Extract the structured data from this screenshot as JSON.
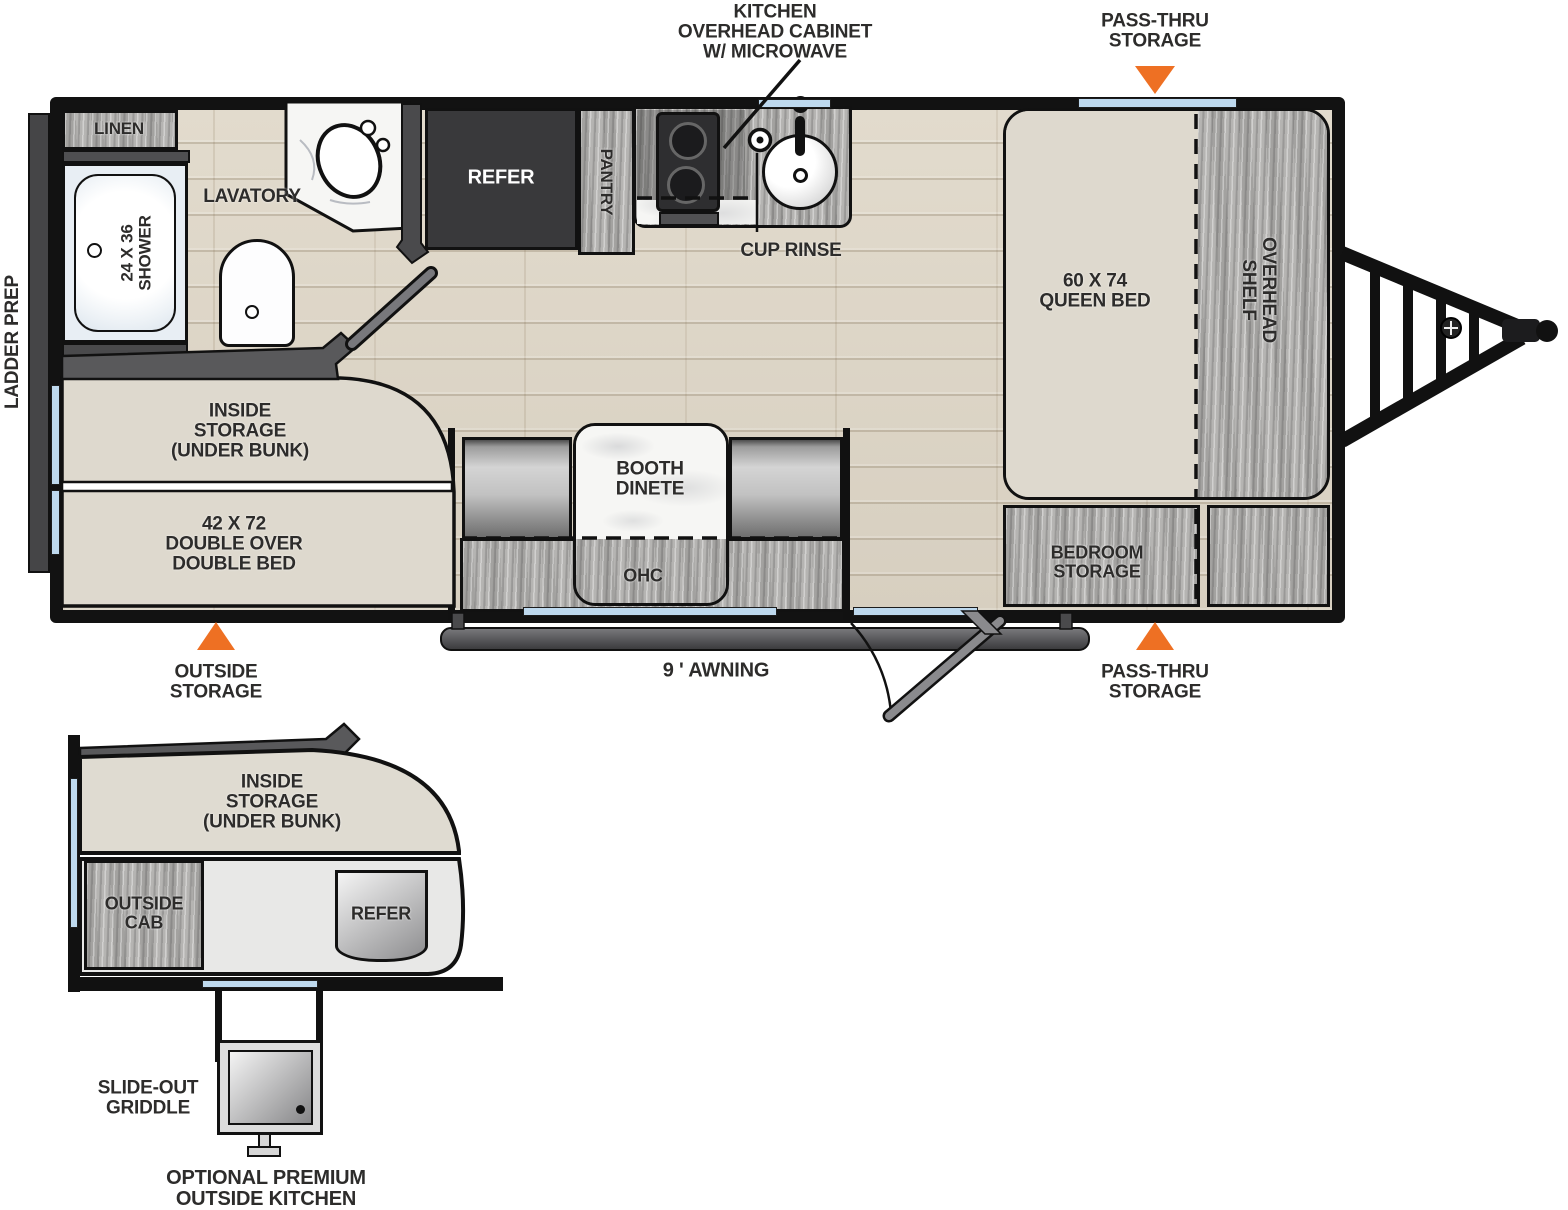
{
  "diagram_title": "travel-trailer-floorplan",
  "colors": {
    "accent_orange": "#ee7023",
    "window_blue": "#bed9ee",
    "wall_black": "#121212",
    "floor_wood": "#dbd4c5",
    "cabinet_gray_wood": "#b5b4b2",
    "appliance_dark": "#39393b",
    "bed_beige": "#ded9ce"
  },
  "top_labels": {
    "kitchen_overhead_cabinet": "KITCHEN\nOVERHEAD CABINET\nW/ MICROWAVE",
    "pass_thru_storage_top": "PASS-THRU\nSTORAGE"
  },
  "main": {
    "ladder_prep": "LADDER PREP",
    "linen": "LINEN",
    "shower": "24 X 36\nSHOWER",
    "lavatory": "LAVATORY",
    "refer": "REFER",
    "pantry": "PANTRY",
    "cup_rinse": "CUP RINSE",
    "queen_bed": "60 X 74\nQUEEN BED",
    "overhead_shelf": "OVERHEAD\nSHELF",
    "inside_storage": "INSIDE\nSTORAGE\n(UNDER BUNK)",
    "double_bed": "42 X 72\nDOUBLE OVER\nDOUBLE BED",
    "booth_dinete": "BOOTH\nDINETE",
    "ohc": "OHC",
    "bedroom_storage": "BEDROOM\nSTORAGE",
    "awning": "9 ' AWNING",
    "outside_storage": "OUTSIDE\nSTORAGE",
    "pass_thru_storage_bottom": "PASS-THRU\nSTORAGE"
  },
  "inset": {
    "inside_storage": "INSIDE\nSTORAGE\n(UNDER BUNK)",
    "outside_cab": "OUTSIDE\nCAB",
    "refer": "REFER",
    "slide_out_griddle": "SLIDE-OUT\nGRIDDLE",
    "optional_outside_kitchen": "OPTIONAL PREMIUM\nOUTSIDE KITCHEN"
  }
}
